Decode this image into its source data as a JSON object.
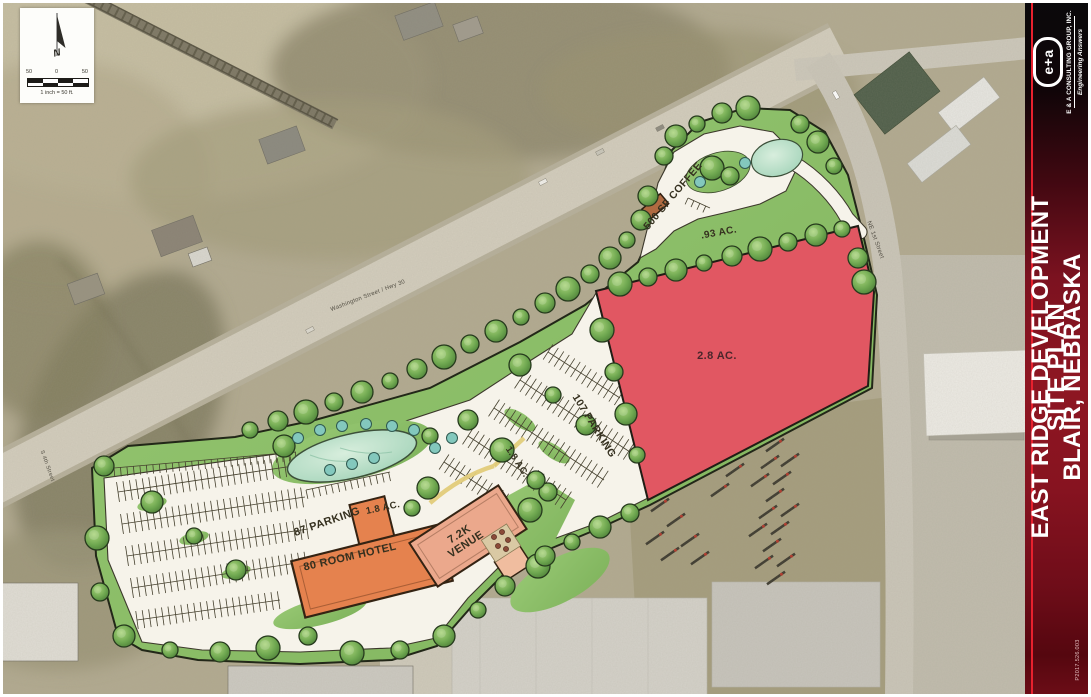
{
  "sheet": {
    "title_lines": [
      "EAST RIDGE DEVELOPMENT",
      "SITE PLAN",
      "BLAIR, NEBRASKA"
    ],
    "project_number": "P2017.526.003"
  },
  "branding": {
    "logo_text": "e+a",
    "company": "E & A CONSULTING GROUP, INC.",
    "tagline": "Engineering Answers"
  },
  "north_scale": {
    "north_letter": "N",
    "left_value": "50",
    "zero_value": "0",
    "right_value": "50",
    "caption": "1 inch = 50 ft."
  },
  "site_labels": {
    "coffee": "500 SF COFFEE",
    "coffee_acreage": ".93 AC.",
    "outlot_acreage": "2.8 AC.",
    "parking_main": "107 PARKING",
    "parking_main_acreage": "1.8 AC.",
    "parking_hotel": "87 PARKING",
    "hotel_acreage": "1.8 AC.",
    "hotel": "80 ROOM HOTEL",
    "venue_line1": "7.2K",
    "venue_line2": "VENUE"
  },
  "streets": {
    "highway": "Washington Street / Hwy 30",
    "ne_first": "NE 1st Street",
    "s_fourth": "S 4th Street"
  },
  "colors": {
    "sidebar_maroon": "#8E1622",
    "accent_red": "#E8212E",
    "outlot_red": "#E15762",
    "site_green": "#8CBD68",
    "pond_green": "#BFE0C8",
    "hotel_orange": "#E5824E",
    "venue_salmon": "#EBA88C",
    "pavement": "#F6F3EA"
  }
}
